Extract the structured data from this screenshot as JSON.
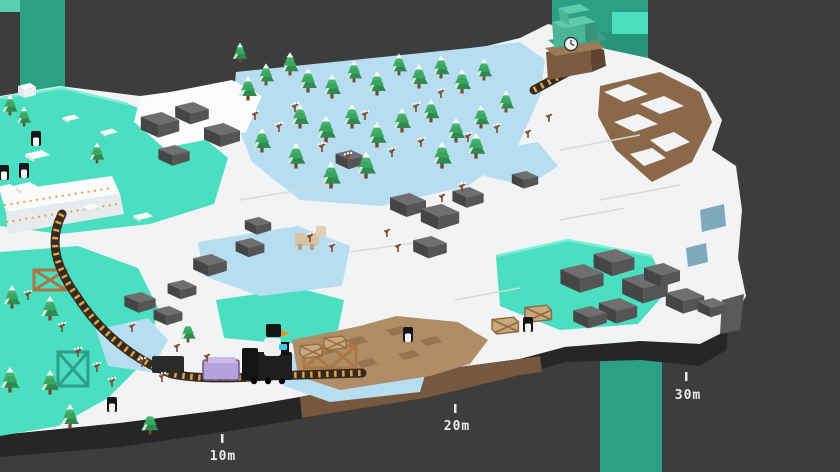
{
  "meta": {
    "app": "voxel-train-game",
    "view": "isometric-floating-island-snow-biome"
  },
  "hud": {
    "distance_markers": [
      {
        "label": "10m"
      },
      {
        "label": "20m"
      },
      {
        "label": "30m"
      }
    ]
  },
  "palette": {
    "background": "#3d3d3d",
    "pillar_teal": "#2ba085",
    "pillar_highlight": "#4be0bd",
    "water_teal": "#49dfc0",
    "ice_blue": "#b7ddf0",
    "snow_white": "#f2f3f4",
    "rock_gray": "#555555",
    "dirt_brown": "#b08d66",
    "island_wall_dark": "#262626",
    "island_wall_brown": "#77573d",
    "tree_green": "#3aa662",
    "track_tie_orange": "#e6a13c",
    "wagon_purple": "#b7a1da",
    "locomotive_black": "#1e1e1e",
    "station_teal": "#4cb596",
    "character_beak_orange": "#e8902a"
  },
  "entities": {
    "train": {
      "locomotive": "black steam locomotive",
      "wagons": [
        "dark wagon",
        "purple wagon"
      ]
    },
    "station": {
      "type": "end station with clock",
      "clock": "analog clock face"
    },
    "bridges": [
      "teal truss bridge",
      "wooden truss bridge small",
      "wooden truss bridge center"
    ],
    "animals": {
      "penguins": 6,
      "tan_animal": 1
    },
    "player_character": "white bird with black head and orange beak"
  },
  "sprites": [
    {
      "name": "pine-tree",
      "symbol": "sym-tree",
      "layer": "trees",
      "items": [
        [
          248,
          100
        ],
        [
          266,
          85,
          0.9
        ],
        [
          290,
          75,
          0.95
        ],
        [
          308,
          92
        ],
        [
          332,
          98
        ],
        [
          354,
          82,
          0.9
        ],
        [
          377,
          95
        ],
        [
          399,
          75,
          0.9
        ],
        [
          419,
          88
        ],
        [
          441,
          78,
          0.95
        ],
        [
          462,
          93
        ],
        [
          484,
          80,
          0.9
        ],
        [
          300,
          128
        ],
        [
          326,
          142,
          1.1
        ],
        [
          352,
          128
        ],
        [
          377,
          147,
          1.05
        ],
        [
          402,
          132
        ],
        [
          431,
          122,
          0.95
        ],
        [
          456,
          142
        ],
        [
          481,
          128,
          0.95
        ],
        [
          506,
          112,
          0.9
        ],
        [
          476,
          158,
          1.05
        ],
        [
          442,
          168,
          1.1
        ],
        [
          366,
          178,
          1.1
        ],
        [
          331,
          188,
          1.1
        ],
        [
          296,
          168,
          1.05
        ],
        [
          262,
          152
        ],
        [
          240,
          62,
          0.8
        ],
        [
          10,
          115,
          0.85
        ],
        [
          24,
          126,
          0.8
        ],
        [
          97,
          163,
          0.85
        ],
        [
          12,
          308,
          0.95
        ],
        [
          50,
          320
        ],
        [
          10,
          392,
          1.05
        ],
        [
          50,
          394
        ],
        [
          70,
          428
        ],
        [
          150,
          434,
          0.95
        ],
        [
          188,
          342,
          0.85
        ]
      ]
    },
    {
      "name": "sapling",
      "symbol": "sym-sapling",
      "layer": "saplings",
      "items": [
        [
          322,
          152
        ],
        [
          348,
          162
        ],
        [
          392,
          157
        ],
        [
          421,
          147
        ],
        [
          468,
          142
        ],
        [
          497,
          133
        ],
        [
          441,
          98
        ],
        [
          416,
          112
        ],
        [
          365,
          120
        ],
        [
          295,
          112
        ],
        [
          310,
          242
        ],
        [
          332,
          252
        ],
        [
          387,
          237
        ],
        [
          398,
          252
        ],
        [
          442,
          202
        ],
        [
          462,
          192
        ],
        [
          28,
          300
        ],
        [
          62,
          332
        ],
        [
          78,
          357
        ],
        [
          97,
          372
        ],
        [
          112,
          387
        ],
        [
          142,
          367
        ],
        [
          162,
          382
        ],
        [
          177,
          352
        ],
        [
          207,
          362
        ],
        [
          132,
          332
        ],
        [
          528,
          138
        ],
        [
          549,
          122
        ],
        [
          255,
          120
        ],
        [
          279,
          132
        ]
      ]
    },
    {
      "name": "ice-floe",
      "symbol": "sym-floe",
      "layer": "floes",
      "items": [
        [
          36,
          152
        ],
        [
          24,
          184
        ],
        [
          4,
          186
        ],
        [
          142,
          214,
          0.8
        ],
        [
          70,
          116,
          0.7
        ],
        [
          108,
          130,
          0.7
        ],
        [
          90,
          205,
          0.7
        ]
      ]
    },
    {
      "name": "penguin",
      "symbol": "sym-penguin",
      "layer": "penguins",
      "items": [
        [
          36,
          146
        ],
        [
          24,
          178
        ],
        [
          4,
          180
        ],
        [
          408,
          342
        ],
        [
          528,
          332
        ],
        [
          112,
          412
        ]
      ]
    },
    {
      "name": "rock",
      "symbol": "sym-rock",
      "layer": "rocks",
      "items": [
        [
          160,
          128,
          1.6
        ],
        [
          192,
          116,
          1.4
        ],
        [
          222,
          138,
          1.5
        ],
        [
          174,
          158,
          1.3
        ],
        [
          250,
          250,
          1.2
        ],
        [
          210,
          268,
          1.4
        ],
        [
          182,
          292,
          1.2
        ],
        [
          140,
          305,
          1.3
        ],
        [
          168,
          318,
          1.2
        ],
        [
          408,
          208,
          1.5
        ],
        [
          440,
          220,
          1.6
        ],
        [
          468,
          200,
          1.3
        ],
        [
          430,
          250,
          1.4
        ],
        [
          582,
          282,
          1.8
        ],
        [
          614,
          266,
          1.7
        ],
        [
          645,
          292,
          1.9
        ],
        [
          618,
          314,
          1.6
        ],
        [
          662,
          278,
          1.5
        ],
        [
          685,
          304,
          1.6
        ],
        [
          590,
          320,
          1.4
        ],
        [
          712,
          310,
          1.2
        ],
        [
          350,
          162,
          1.2
        ],
        [
          525,
          182,
          1.1
        ],
        [
          258,
          228,
          1.1
        ]
      ]
    },
    {
      "name": "crate",
      "symbol": "sym-crate",
      "layer": "crates",
      "items": [
        [
          310,
          358
        ],
        [
          334,
          350
        ],
        [
          504,
          334,
          1.2
        ],
        [
          537,
          322,
          1.2
        ]
      ]
    }
  ]
}
